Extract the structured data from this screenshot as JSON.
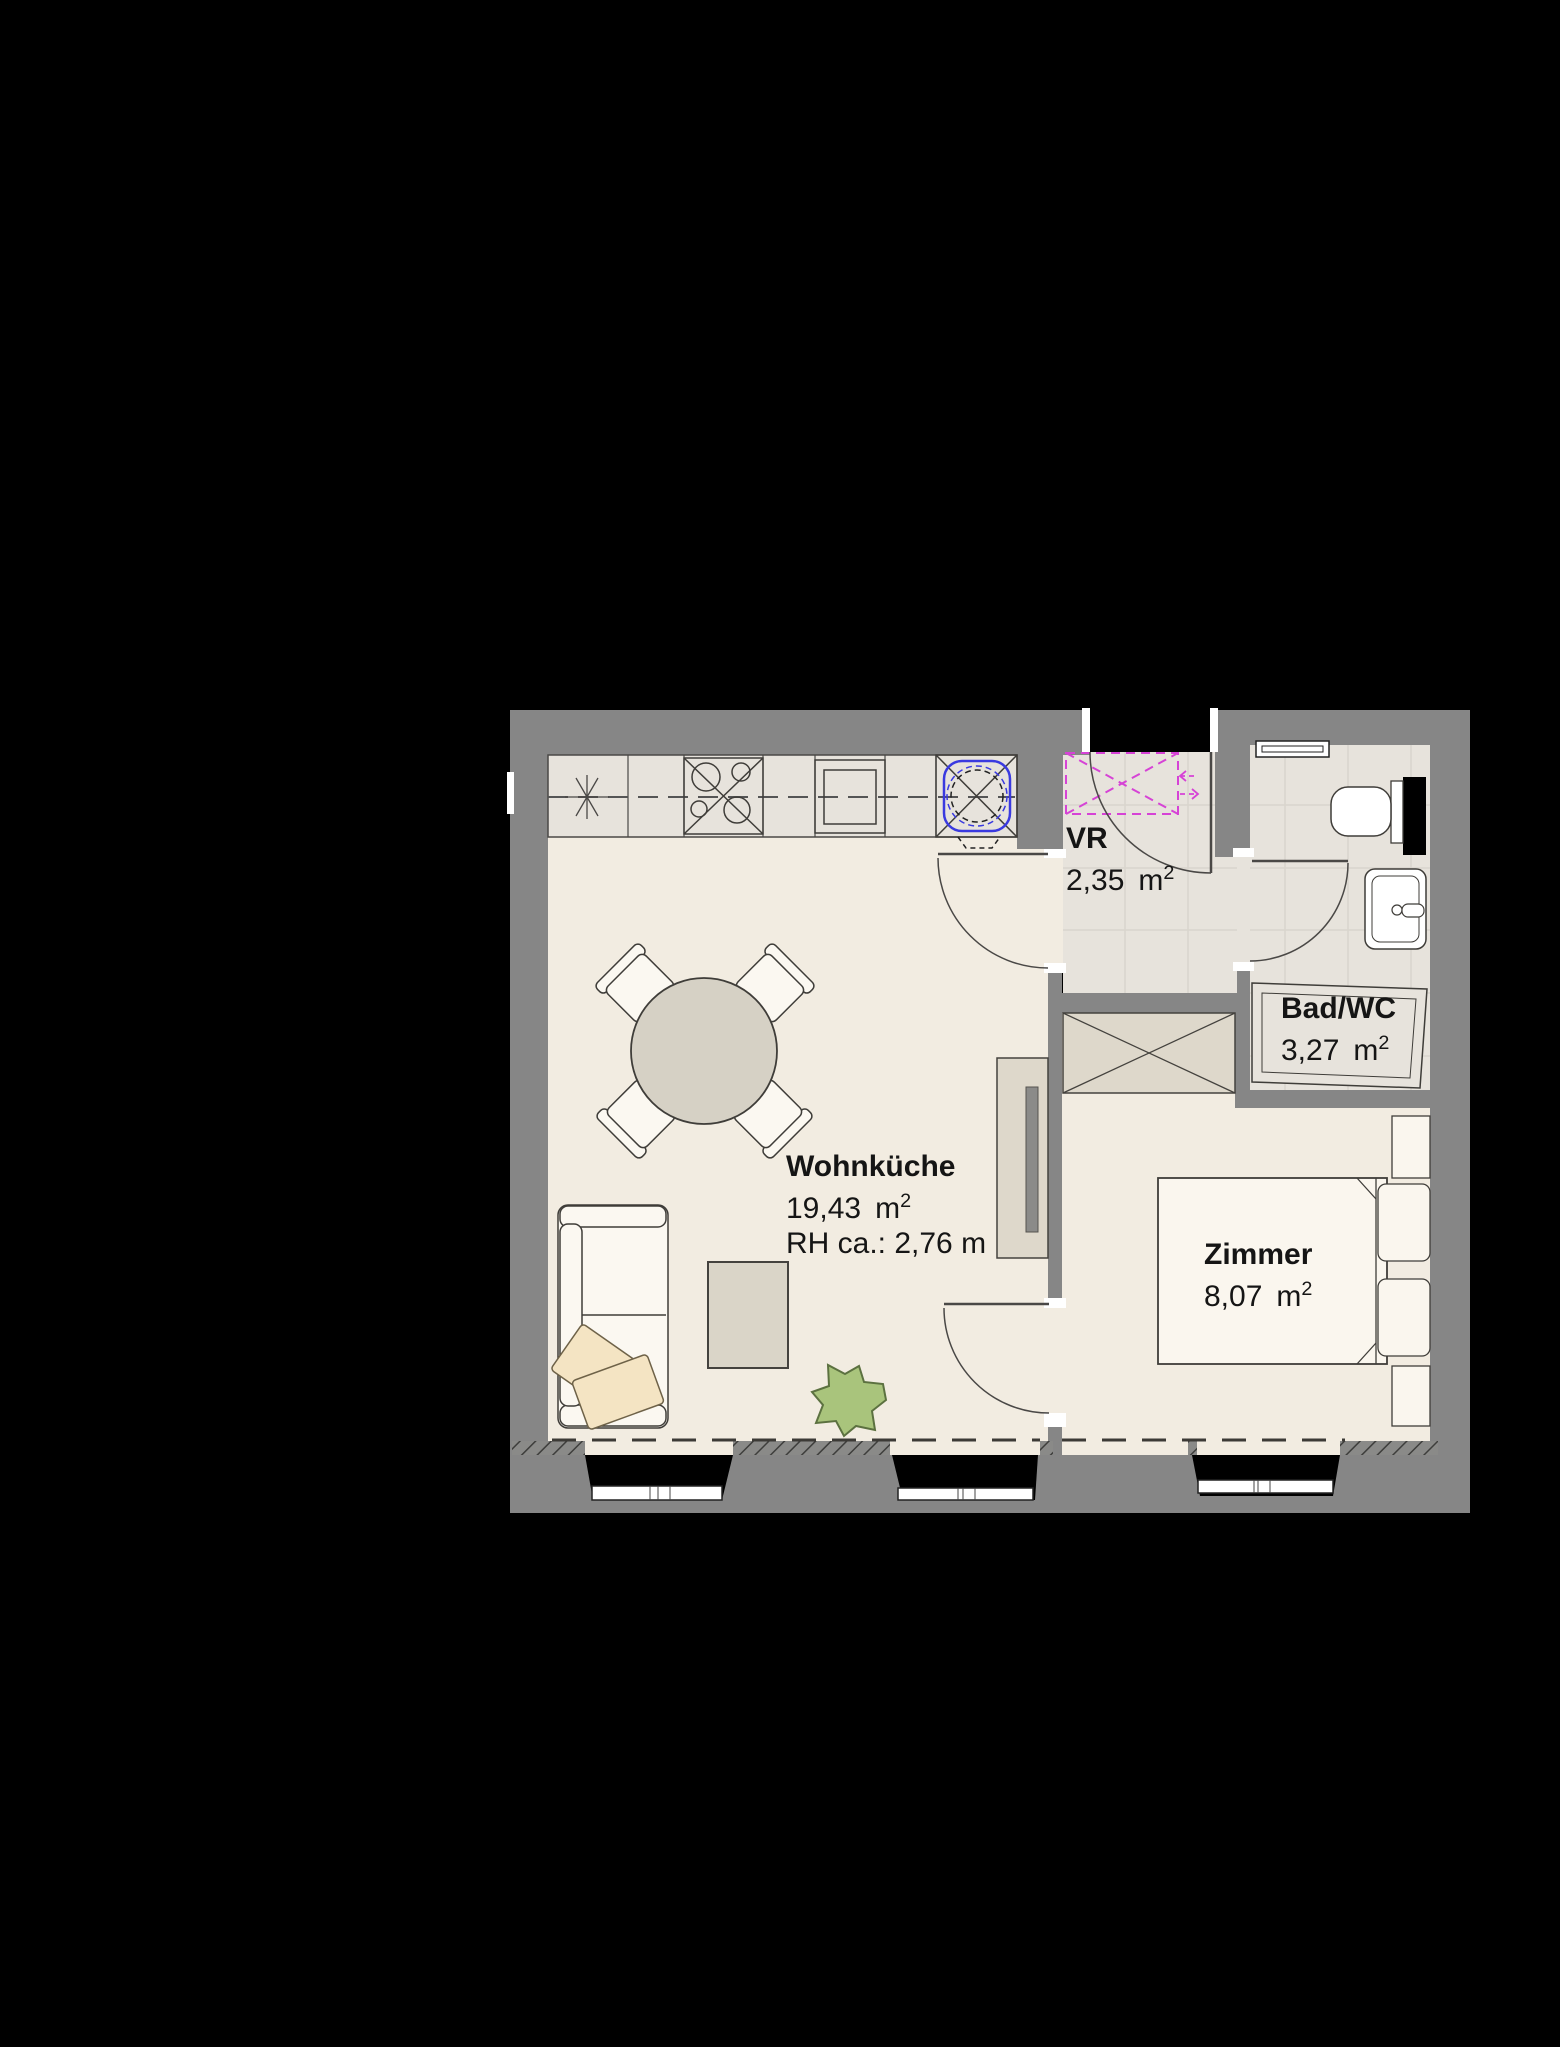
{
  "document": {
    "kind": "apartment floor plan",
    "background": "#000000"
  },
  "palette": {
    "wall_gray": "#868686",
    "floor_cream": "#f2ece1",
    "floor_tile": "#e7e3dc",
    "furniture_white": "#fbf8f1",
    "furniture_beige": "#ded8cb",
    "table_fill": "#d6d1c5",
    "pillow_beige": "#f4e4c3",
    "plant_green": "#a9c47c",
    "washer_magenta": "#d643d6",
    "sink_blue": "#3a3ae0",
    "outline_dark": "#3f3d39",
    "window_frame_white": "#ffffff"
  },
  "rooms": [
    {
      "id": "wohnkueche",
      "name": "Wohnküche",
      "area_value": "19,43",
      "area_unit": "m",
      "area_exponent": "2",
      "note": "RH ca.: 2,76 m"
    },
    {
      "id": "vr",
      "name": "VR",
      "area_value": "2,35",
      "area_unit": "m",
      "area_exponent": "2"
    },
    {
      "id": "bad_wc",
      "name": "Bad/WC",
      "area_value": "3,27",
      "area_unit": "m",
      "area_exponent": "2"
    },
    {
      "id": "zimmer",
      "name": "Zimmer",
      "area_value": "8,07",
      "area_unit": "m",
      "area_exponent": "2"
    }
  ],
  "symbols": [
    "kitchen-counter",
    "lamp-symbol",
    "cooktop",
    "oven",
    "kitchen-sink",
    "dining-table",
    "chairs",
    "sofa",
    "pillows",
    "coffee-table",
    "plant",
    "tv-sideboard",
    "washing-machine-provision",
    "entrance-door",
    "interior-doors",
    "wardrobe",
    "bed",
    "nightstands",
    "bathtub",
    "toilet",
    "washbasin",
    "bathroom-window",
    "windows"
  ]
}
